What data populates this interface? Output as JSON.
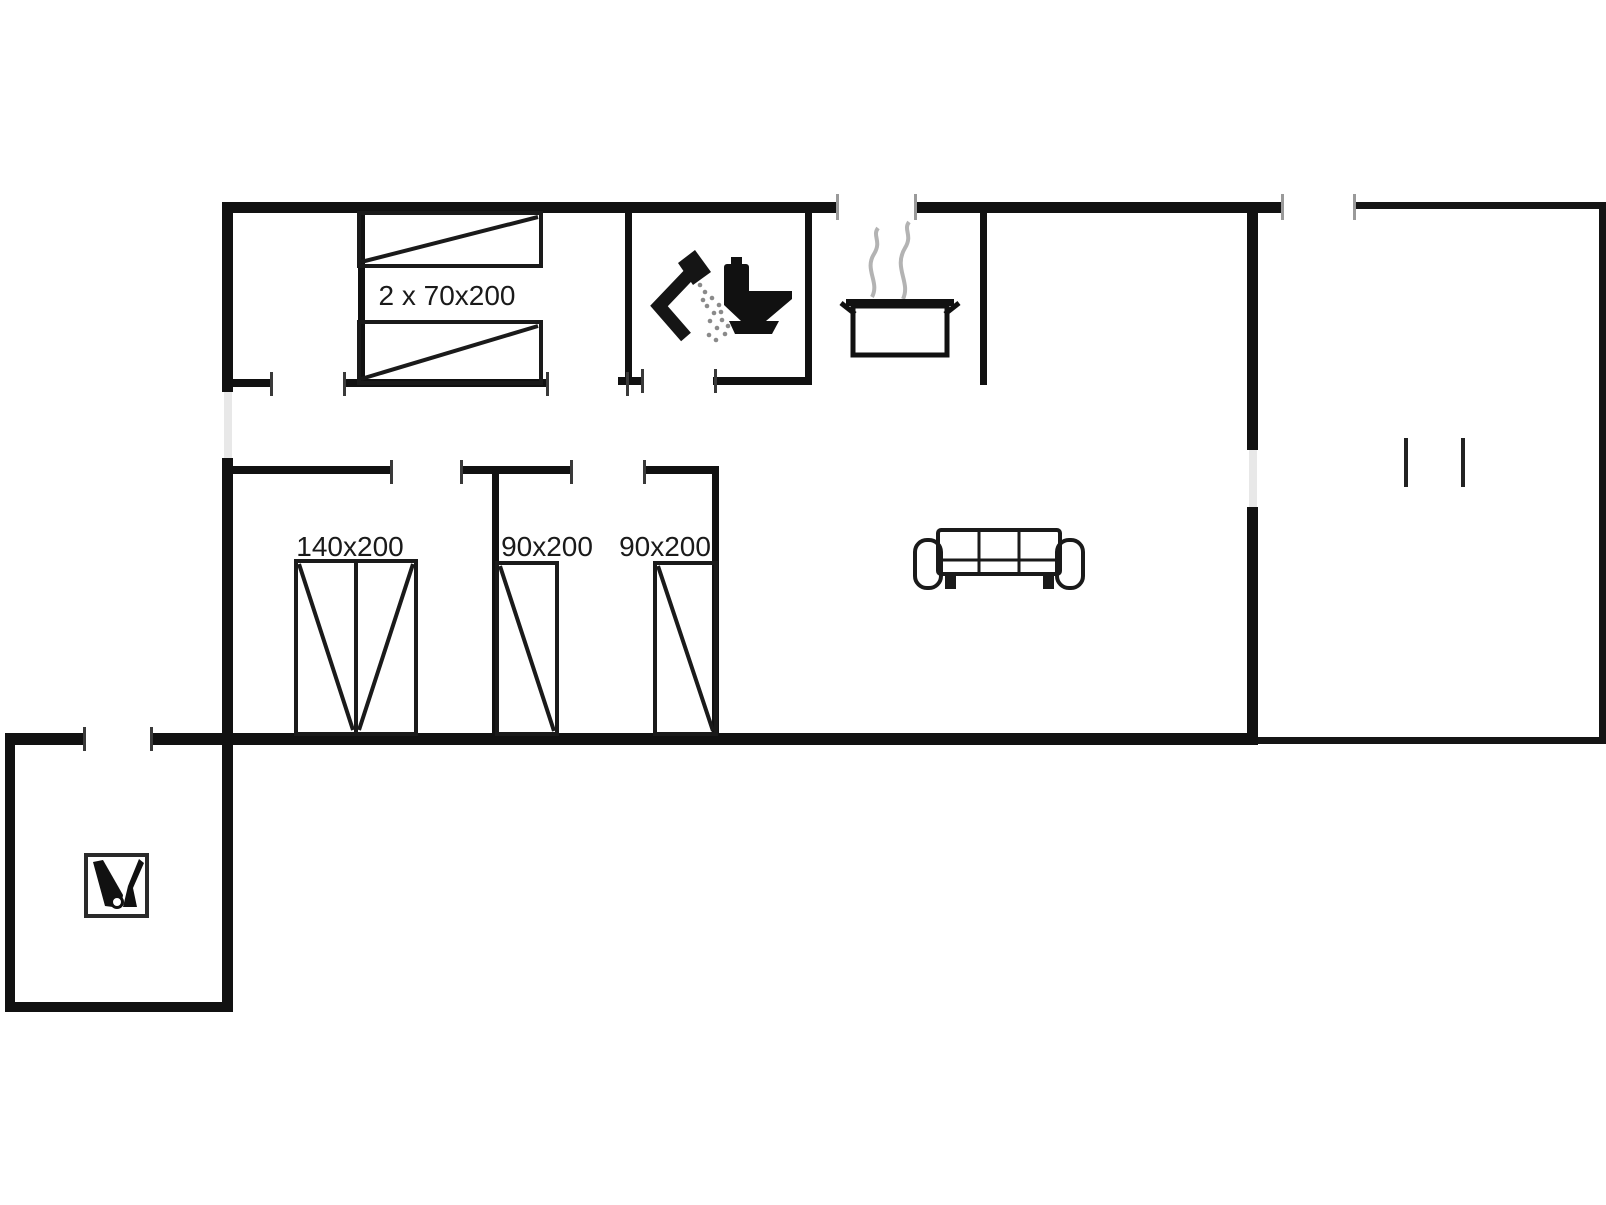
{
  "floor_plan": {
    "labels": {
      "bunk_beds": "2 x 70x200",
      "double_bed": "140x200",
      "single_bed_1": "90x200",
      "single_bed_2": "90x200"
    },
    "colors": {
      "background": "#ffffff",
      "walls": "#111111",
      "text": "#1a1a1a",
      "steam": "#b3b3b3"
    },
    "icons": [
      "shower-icon",
      "toilet-icon",
      "cooking-pot-icon",
      "steam-icon",
      "sofa-icon",
      "cleaning-tools-icon",
      "terrace-post-marks"
    ]
  }
}
